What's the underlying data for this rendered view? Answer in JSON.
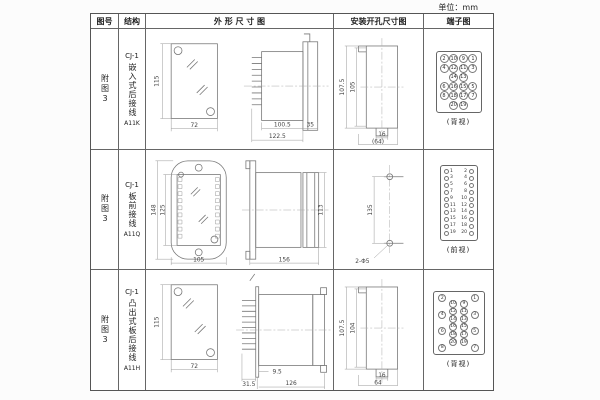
{
  "page": {
    "unit_label": "单位：mm"
  },
  "table": {
    "headers": [
      "图号",
      "结构",
      "外 形 尺 寸 图",
      "安装开孔尺寸图",
      "端子图"
    ],
    "rows": [
      {
        "fig_no": "附图3",
        "structure": {
          "model": "CJ-1",
          "type": "嵌入式后接线",
          "code": "A11K"
        },
        "outline": {
          "front_h": "115",
          "front_w": "72",
          "d1": "100.5",
          "d2": "122.5",
          "d3": "35"
        },
        "install": {
          "h1": "107.5",
          "h2": "105",
          "w1": "16",
          "w2": "(64)"
        },
        "terminal": {
          "caption": "(背视)",
          "layout": "grid",
          "rows": [
            [
              "2",
              "10",
              "9",
              "1"
            ],
            [
              "4",
              "12",
              "11",
              "3"
            ],
            [
              "",
              "14",
              "13",
              ""
            ],
            [
              "6",
              "16",
              "15",
              "5"
            ],
            [
              "8",
              "18",
              "17",
              "7"
            ],
            [
              "",
              "20",
              "19",
              ""
            ]
          ]
        }
      },
      {
        "fig_no": "附图3",
        "structure": {
          "model": "CJ-1",
          "type": "板前接线",
          "code": "A11Q"
        },
        "outline": {
          "front_h": "148",
          "front_h2": "125",
          "front_w": "105",
          "side_len": "156",
          "side_h": "113"
        },
        "install": {
          "pitch": "135",
          "hole": "2-Φ5"
        },
        "terminal": {
          "caption": "(前视)",
          "layout": "pairs",
          "pairs": [
            [
              "1",
              "2"
            ],
            [
              "3",
              "4"
            ],
            [
              "5",
              "6"
            ],
            [
              "7",
              "8"
            ],
            [
              "9",
              "10"
            ],
            [
              "11",
              "12"
            ],
            [
              "13",
              "14"
            ],
            [
              "15",
              "16"
            ],
            [
              "17",
              "18"
            ],
            [
              "19",
              "20"
            ]
          ]
        }
      },
      {
        "fig_no": "附图3",
        "structure": {
          "model": "CJ-1",
          "type": "凸出式板后接线",
          "code": "A11H"
        },
        "outline": {
          "front_h": "115",
          "front_w": "72",
          "d1": "31.5",
          "d2": "9.5",
          "d3": "126"
        },
        "install": {
          "h1": "107.5",
          "h2": "104",
          "w1": "16",
          "w2": "64"
        },
        "terminal": {
          "caption": "(背视)",
          "layout": "stagger",
          "columns": [
            [
              "2",
              "4",
              "6",
              "8"
            ],
            [
              "10",
              "12",
              "14",
              "16",
              "18",
              "20"
            ],
            [
              "9",
              "11",
              "13",
              "15",
              "17",
              "19"
            ],
            [
              "1",
              "3",
              "5",
              "7"
            ]
          ]
        }
      }
    ]
  }
}
